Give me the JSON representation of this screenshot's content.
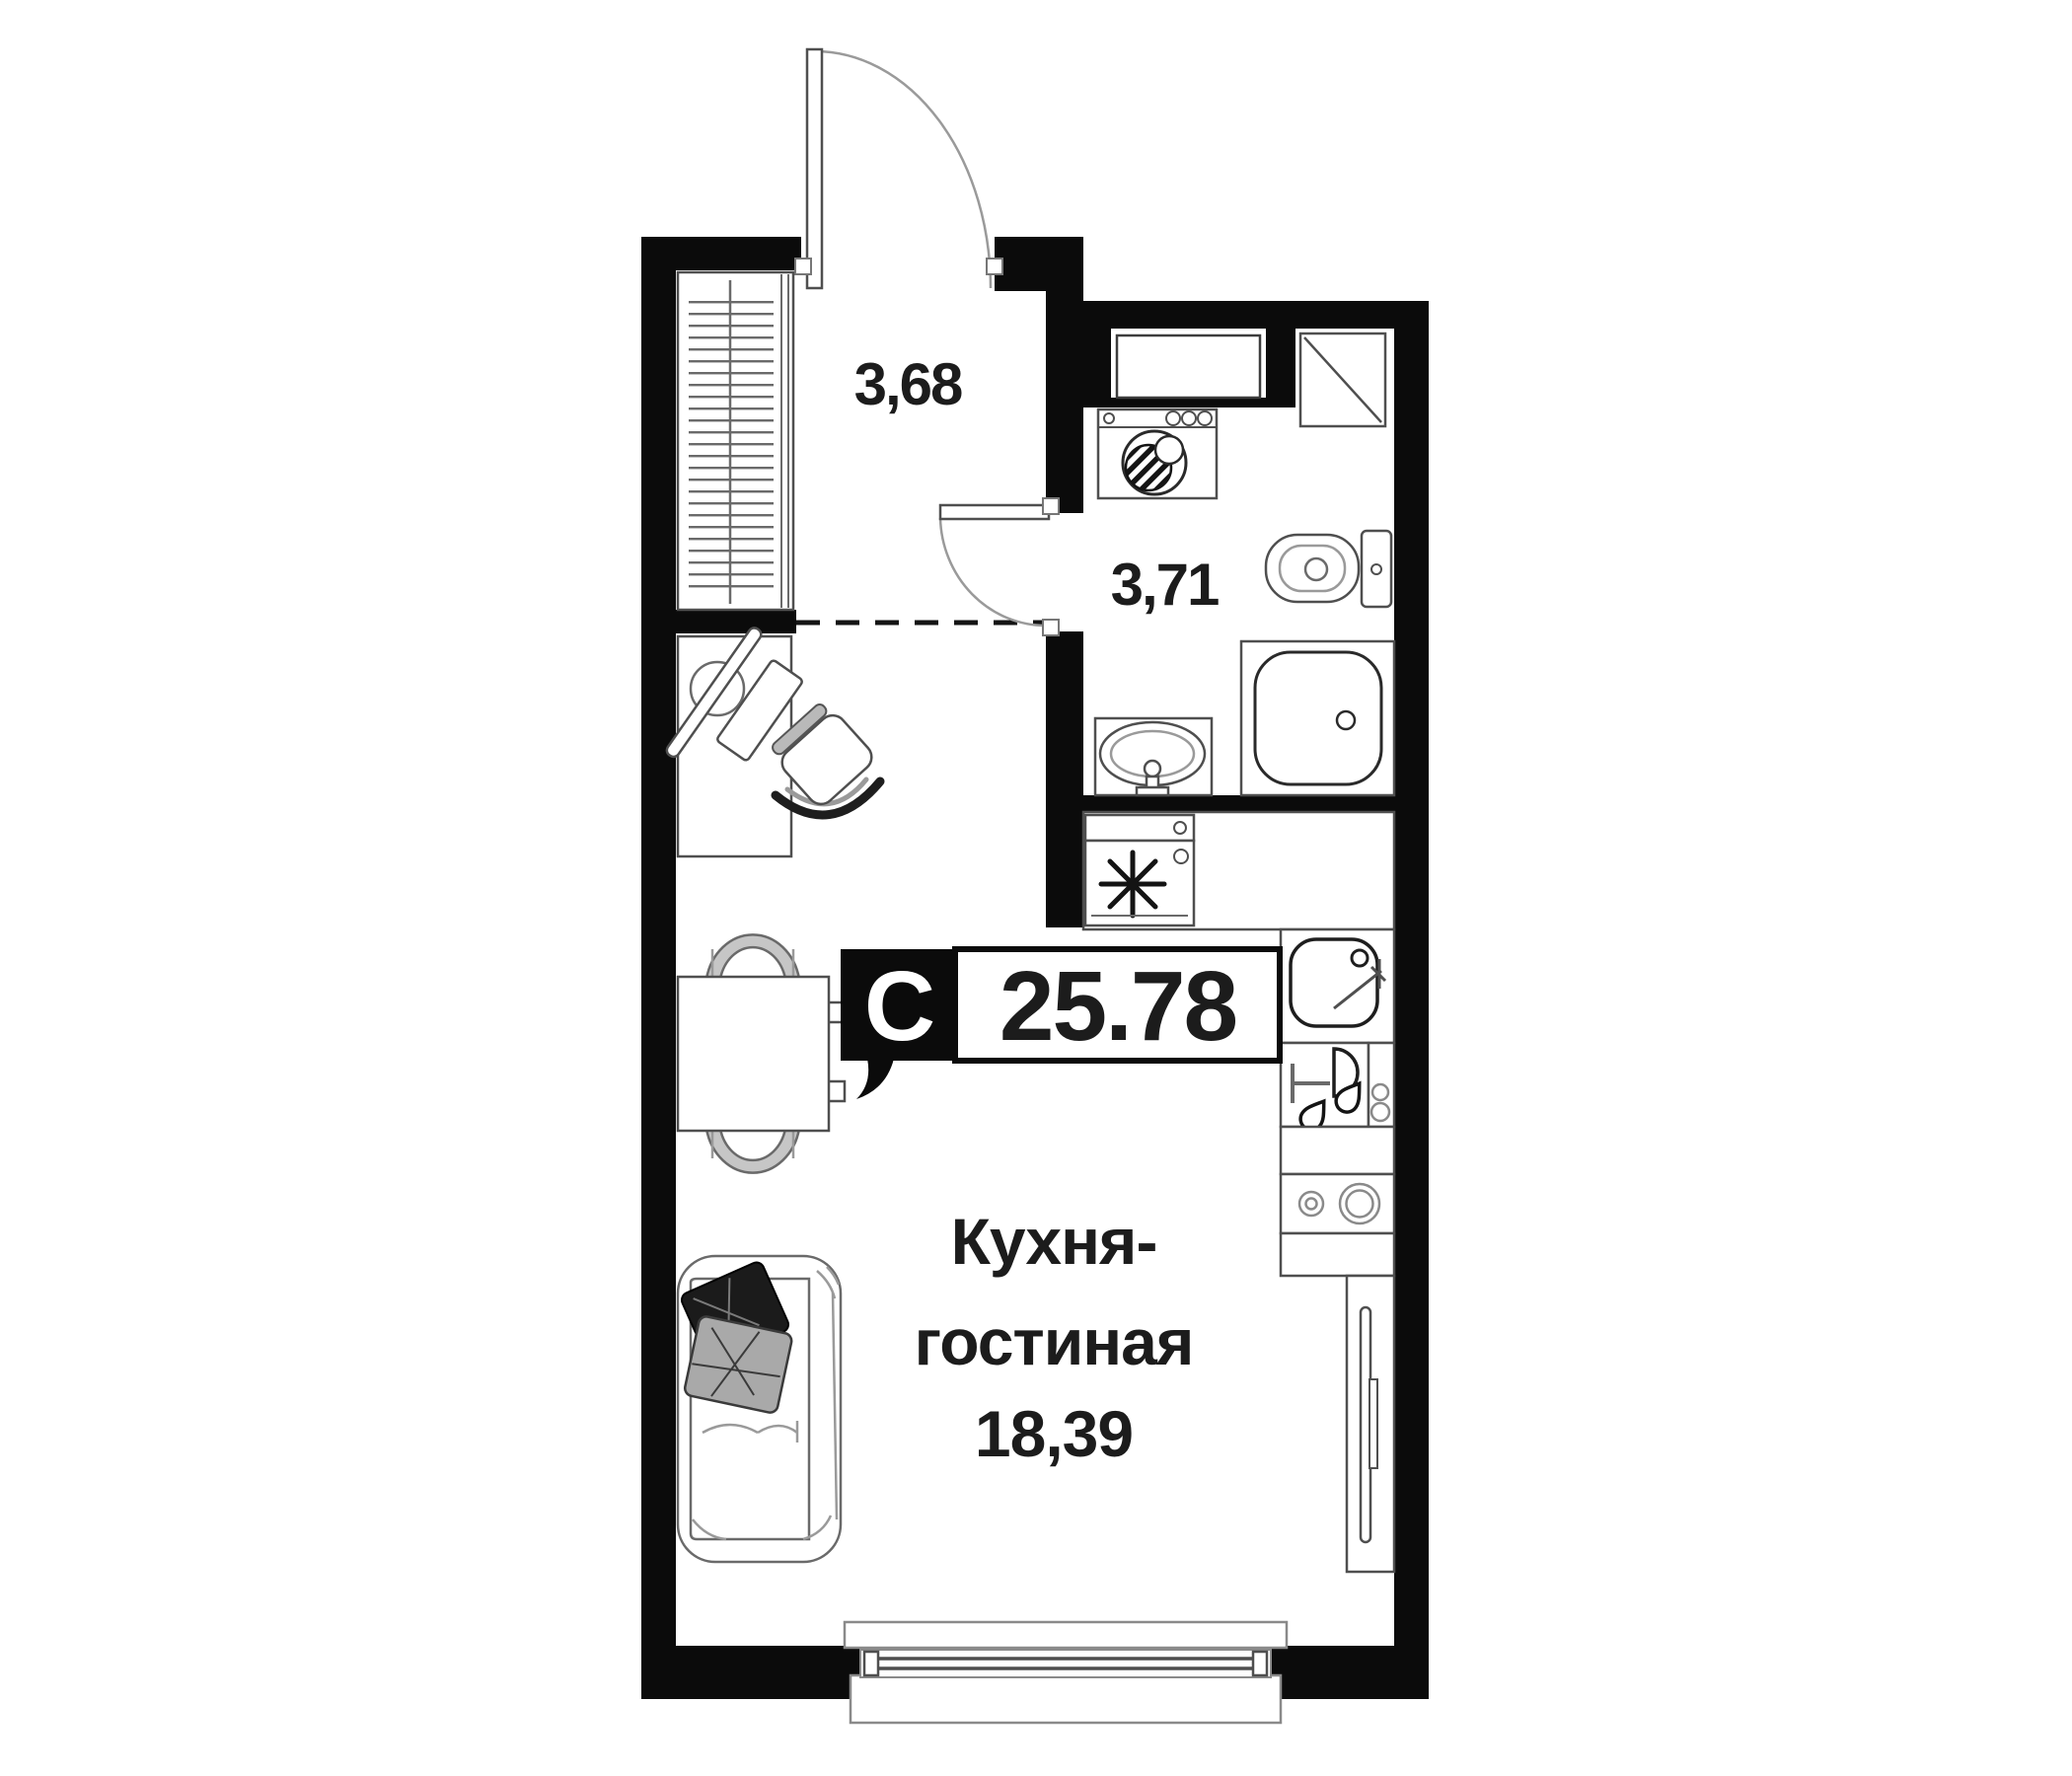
{
  "badge": {
    "type_label": "С",
    "area_value": "25.78"
  },
  "rooms": {
    "hallway": {
      "area_label": "3,68"
    },
    "bathroom": {
      "area_label": "3,71"
    },
    "kitchen_living": {
      "name_line1": "Кухня-",
      "name_line2": "гостиная",
      "area_label": "18,39"
    }
  },
  "colors": {
    "background": "#ffffff",
    "wall": "#0b0b0b",
    "text": "#1c1c1c",
    "furniture_stroke": "#4f4f4f",
    "light_stroke": "#9a9a9a",
    "pillow_dark": "#1b1b1b",
    "pillow_light": "#a9a9a9",
    "chair_fill": "#c6c6c6",
    "badge_text_light": "#ffffff"
  },
  "fixtures": [
    "entrance-door",
    "wardrobe",
    "desk",
    "office-chair",
    "bathroom-door",
    "washing-machine",
    "vent-shaft",
    "corner-shelf",
    "toilet",
    "shower",
    "wash-basin",
    "refrigerator",
    "kitchen-sink",
    "glassware-cabinet",
    "hob",
    "tv-unit",
    "dining-table",
    "dining-chairs",
    "sofa",
    "pillows",
    "window"
  ]
}
